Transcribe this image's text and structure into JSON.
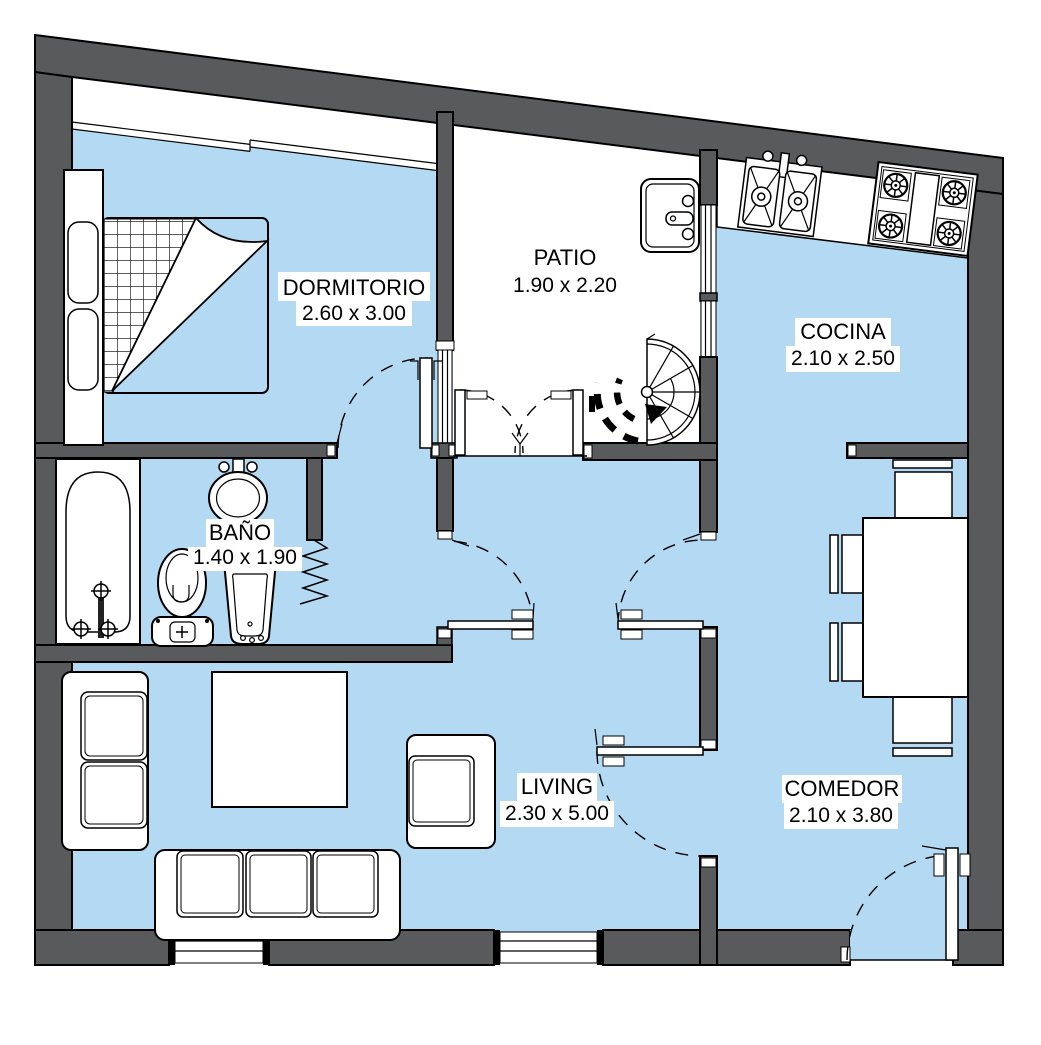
{
  "floor_plan": {
    "rooms": {
      "dormitorio": {
        "name": "DORMITORIO",
        "size": "2.60 x 3.00"
      },
      "patio": {
        "name": "PATIO",
        "size": "1.90 x 2.20"
      },
      "cocina": {
        "name": "COCINA",
        "size": "2.10 x 2.50"
      },
      "bano": {
        "name": "BAÑO",
        "size": "1.40 x 1.90"
      },
      "living": {
        "name": "LIVING",
        "size": "2.30 x 5.00"
      },
      "comedor": {
        "name": "COMEDOR",
        "size": "2.10 x 3.80"
      }
    },
    "colors": {
      "floor": "#b4daf3",
      "patio_floor": "#ffffff",
      "wall": "#595a5c",
      "outline": "#000000",
      "label_bg": "#ffffff",
      "label_text": "#000000"
    }
  }
}
